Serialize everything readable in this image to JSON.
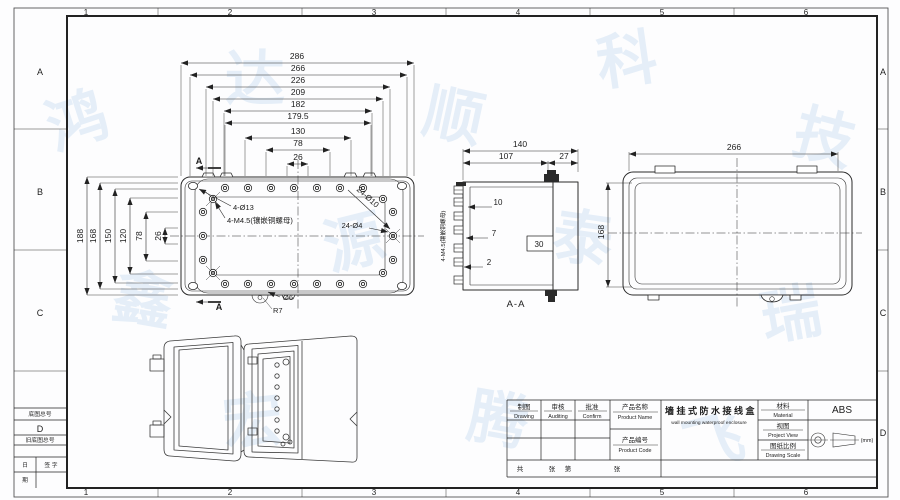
{
  "watermark": {
    "color": "#5b9bd5",
    "glyphs": [
      "鸿",
      "达",
      "顺",
      "科",
      "技",
      "鑫",
      "源",
      "泰",
      "瑞",
      "宏",
      "腾",
      "飞"
    ]
  },
  "border": {
    "zone_numbers": [
      "1",
      "2",
      "3",
      "4",
      "5",
      "6"
    ],
    "zone_letters": [
      "A",
      "B",
      "C",
      "D"
    ]
  },
  "corner_block": {
    "base_drawing_no": "底图总号",
    "old_base_drawing_no": "旧底图总号",
    "date_top": "日",
    "date_bottom": "期",
    "signature": "签 字"
  },
  "plate_view": {
    "h_dims": [
      "286",
      "266",
      "226",
      "209",
      "182",
      "179.5",
      "130",
      "78",
      "26"
    ],
    "v_dims": [
      "188",
      "168",
      "150",
      "120",
      "78",
      "26"
    ],
    "corner_holes_label": "4-Ø13",
    "insert_label": "4-M4.5(镶嵌铜螺母)",
    "ring_holes_outer_label": "24-Ø10",
    "ring_holes_inner_label": "24-Ø4",
    "notch_dia_label": "Ø6",
    "notch_radius_label": "R7",
    "section_letter": "A"
  },
  "section_view": {
    "overall_width": "140",
    "inner_width": "107",
    "lid_depth": "27",
    "gland_dim_1": "10",
    "gland_dim_2": "7",
    "gland_dim_3": "2",
    "notch_dim": "30",
    "side_label": "4-M4.5(镶嵌铜螺母)",
    "caption": "A-A"
  },
  "lid_view": {
    "width": "266",
    "height": "168"
  },
  "title_block": {
    "drawing_cn": "制图",
    "drawing_en": "Drawing",
    "auditing_cn": "审核",
    "auditing_en": "Auditing",
    "confirm_cn": "批准",
    "confirm_en": "Confirm",
    "product_name_cn": "产品名称",
    "product_name_en": "Product Name",
    "product_title_cn": "墙挂式防水接线盒",
    "product_title_en": "wall mounting waterproof enclosure",
    "product_code_cn": "产品编号",
    "product_code_en": "Product Code",
    "material_cn": "材料",
    "material_en": "Material",
    "material_value": "ABS",
    "view_cn": "视图",
    "view_en": "Project View",
    "scale_cn": "图纸比例",
    "scale_en": "Drawing Scale",
    "unit": "(mm)",
    "sheet_char_1": "共",
    "sheet_char_2": "张",
    "sheet_char_3": "第",
    "sheet_char_4": "张"
  }
}
